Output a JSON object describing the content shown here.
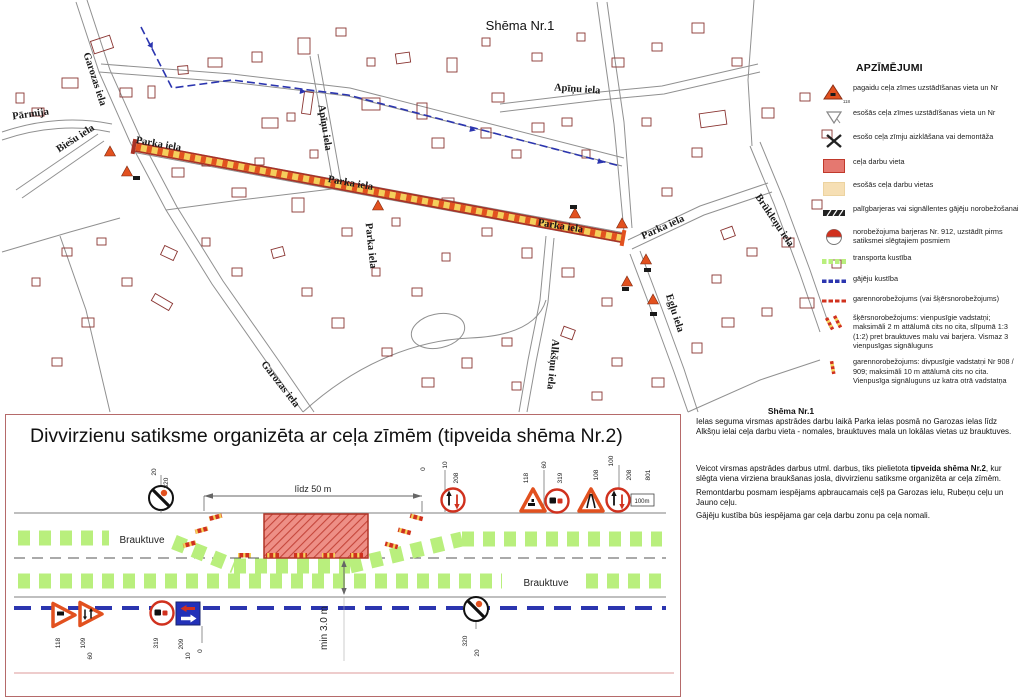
{
  "map": {
    "title": "Shēma Nr.1",
    "street_labels": [
      {
        "t": "Garozas iela",
        "x": 92,
        "y": 80,
        "r": 72
      },
      {
        "t": "Pārmija",
        "x": 31,
        "y": 117,
        "r": -8
      },
      {
        "t": "Biešu iela",
        "x": 77,
        "y": 141,
        "r": -33
      },
      {
        "t": "Parka iela",
        "x": 158,
        "y": 147,
        "r": 10
      },
      {
        "t": "Parka iela",
        "x": 350,
        "y": 186,
        "r": 10
      },
      {
        "t": "Parka iela",
        "x": 560,
        "y": 229,
        "r": 9
      },
      {
        "t": "Parka iela",
        "x": 368,
        "y": 246,
        "r": 84
      },
      {
        "t": "Parka iela",
        "x": 664,
        "y": 230,
        "r": -24
      },
      {
        "t": "Apīņu iela",
        "x": 322,
        "y": 128,
        "r": 81
      },
      {
        "t": "Apīņu iela",
        "x": 577,
        "y": 92,
        "r": 4
      },
      {
        "t": "Brūkleņu iela",
        "x": 772,
        "y": 222,
        "r": 56
      },
      {
        "t": "Egļu iela",
        "x": 672,
        "y": 314,
        "r": 72
      },
      {
        "t": "Alkšņu iela",
        "x": 550,
        "y": 364,
        "r": 96
      },
      {
        "t": "Garozas iela",
        "x": 278,
        "y": 386,
        "r": 52
      }
    ]
  },
  "legend": {
    "title": "APZĪMĒJUMI",
    "items": [
      {
        "icon": "temp-sign-triangle-icon",
        "note": "118",
        "label": "pagaidu ceļa zīmes uzstādīšanas vieta un Nr"
      },
      {
        "icon": "existing-sign-triangle-icon",
        "label": "esošās ceļa zīmes uzstādīšanas vieta un Nr"
      },
      {
        "icon": "sign-removal-x-icon",
        "label": "esošo ceļa zīmju aizklāšana vai demontāža"
      },
      {
        "icon": "work-zone-swatch",
        "label": "ceļa darbu vieta"
      },
      {
        "icon": "existing-work-zone-swatch",
        "label": "esošās ceļa darbu vietas"
      },
      {
        "icon": "barrier-tape-icon",
        "label": "palīgbarjeras vai signāllentes gājēju norobežošanai"
      },
      {
        "icon": "barrier-912-icon",
        "label": "norobežojuma barjeras Nr. 912, uzstādīt pirms satiksmei slēgtajiem posmiem"
      },
      {
        "icon": "transport-flow-icon",
        "label": "transporta kustība"
      },
      {
        "icon": "pedestrian-flow-icon",
        "label": "gājēju kustība"
      },
      {
        "icon": "longitudinal-barrier-icon",
        "label": "garennorobežojums (vai šķērsnorobežojums)"
      },
      {
        "icon": "cross-barrier-posts-icon",
        "label": "šķērsnorobežojums: vienpusīgie vadstatņi; maksimāli 2 m attālumā cits no cita, slīpumā 1:3 (1:2) pret brauktuves malu vai barjera. Vismaz 3 vienpusīgas signāluguns"
      },
      {
        "icon": "longitudinal-posts-icon",
        "label": "garennorobežojums: divpusīgie vadstatņi Nr 908 / 909; maksimāli 10 m attālumā cits no cita. Vienpusīga signāluguns uz katra otrā vadstatņa"
      }
    ]
  },
  "detail": {
    "title": "Divvirzienu satiksme organizēta ar ceļa zīmēm (tipveida shēma Nr.2)",
    "labels": [
      {
        "t": "20",
        "x": 150,
        "y": 57,
        "r": -90
      },
      {
        "t": "320",
        "x": 162,
        "y": 68,
        "r": -90
      },
      {
        "t": "līdz 50 m",
        "x": 307,
        "y": 77,
        "s": 9,
        "b": 1
      },
      {
        "t": "0",
        "x": 419,
        "y": 54,
        "r": -90
      },
      {
        "t": "10",
        "x": 441,
        "y": 50,
        "r": -90
      },
      {
        "t": "208",
        "x": 452,
        "y": 63,
        "r": -90
      },
      {
        "t": "118",
        "x": 522,
        "y": 63,
        "r": -90
      },
      {
        "t": "60",
        "x": 540,
        "y": 50,
        "r": -90
      },
      {
        "t": "319",
        "x": 556,
        "y": 63,
        "r": -90
      },
      {
        "t": "108",
        "x": 592,
        "y": 60,
        "r": -90
      },
      {
        "t": "100",
        "x": 607,
        "y": 46,
        "r": -90
      },
      {
        "t": "208",
        "x": 625,
        "y": 60,
        "r": -90
      },
      {
        "t": "801",
        "x": 644,
        "y": 60,
        "r": -90
      },
      {
        "t": "100m",
        "x": 636,
        "y": 88,
        "s": 6
      },
      {
        "t": "Brauktuve",
        "x": 136,
        "y": 128,
        "s": 10,
        "b": 1
      },
      {
        "t": "Brauktuve",
        "x": 540,
        "y": 171,
        "s": 10,
        "b": 1
      },
      {
        "t": "min 3.0 m",
        "x": 321,
        "y": 213,
        "r": -90,
        "s": 10
      },
      {
        "t": "118",
        "x": 54,
        "y": 228,
        "r": -90
      },
      {
        "t": "109",
        "x": 79,
        "y": 228,
        "r": -90
      },
      {
        "t": "60",
        "x": 86,
        "y": 241,
        "r": -90
      },
      {
        "t": "319",
        "x": 152,
        "y": 228,
        "r": -90
      },
      {
        "t": "209",
        "x": 177,
        "y": 229,
        "r": -90
      },
      {
        "t": "10",
        "x": 184,
        "y": 241,
        "r": -90
      },
      {
        "t": "0",
        "x": 196,
        "y": 236,
        "r": -90
      },
      {
        "t": "320",
        "x": 461,
        "y": 226,
        "r": -90
      },
      {
        "t": "20",
        "x": 473,
        "y": 238,
        "r": -90
      }
    ]
  },
  "notes": {
    "title": "Shēma Nr.1",
    "p1": "Ielas seguma virsmas apstrādes darbu laikā Parka ielas posmā no Garozas ielas līdz Alkšņu ielai ceļa darbu vieta - nomales, brauktuves mala un lokālas vietas uz brauktuves.",
    "p2_prefix": "Veicot virsmas apstrādes darbus utml. darbus, tiks pielietota ",
    "p2_bold": "tipveida shēma Nr.2",
    "p2_suffix": ", kur slēgta viena virziena braukšanas josla, divvirzienu satiksme organizēta ar ceļa zīmēm.",
    "p3": "Remontdarbu posmam iespējams apbraucamais ceļš pa Garozas ielu, Rubeņu ceļu un Jauno ceļu.",
    "p4": "Gājēju kustība būs iespējama gar ceļa darbu zonu pa ceļa nomali."
  },
  "colors": {
    "work_zone": "#e57870",
    "existing_work_zone": "#f6dfb4",
    "transport_flow_green": "#b9ef7d",
    "pedestrian_blue": "#2b35af",
    "barrier_red": "#d0311e",
    "road_outline": "#a93226",
    "road_fill_yellow": "#f4cf5c"
  }
}
